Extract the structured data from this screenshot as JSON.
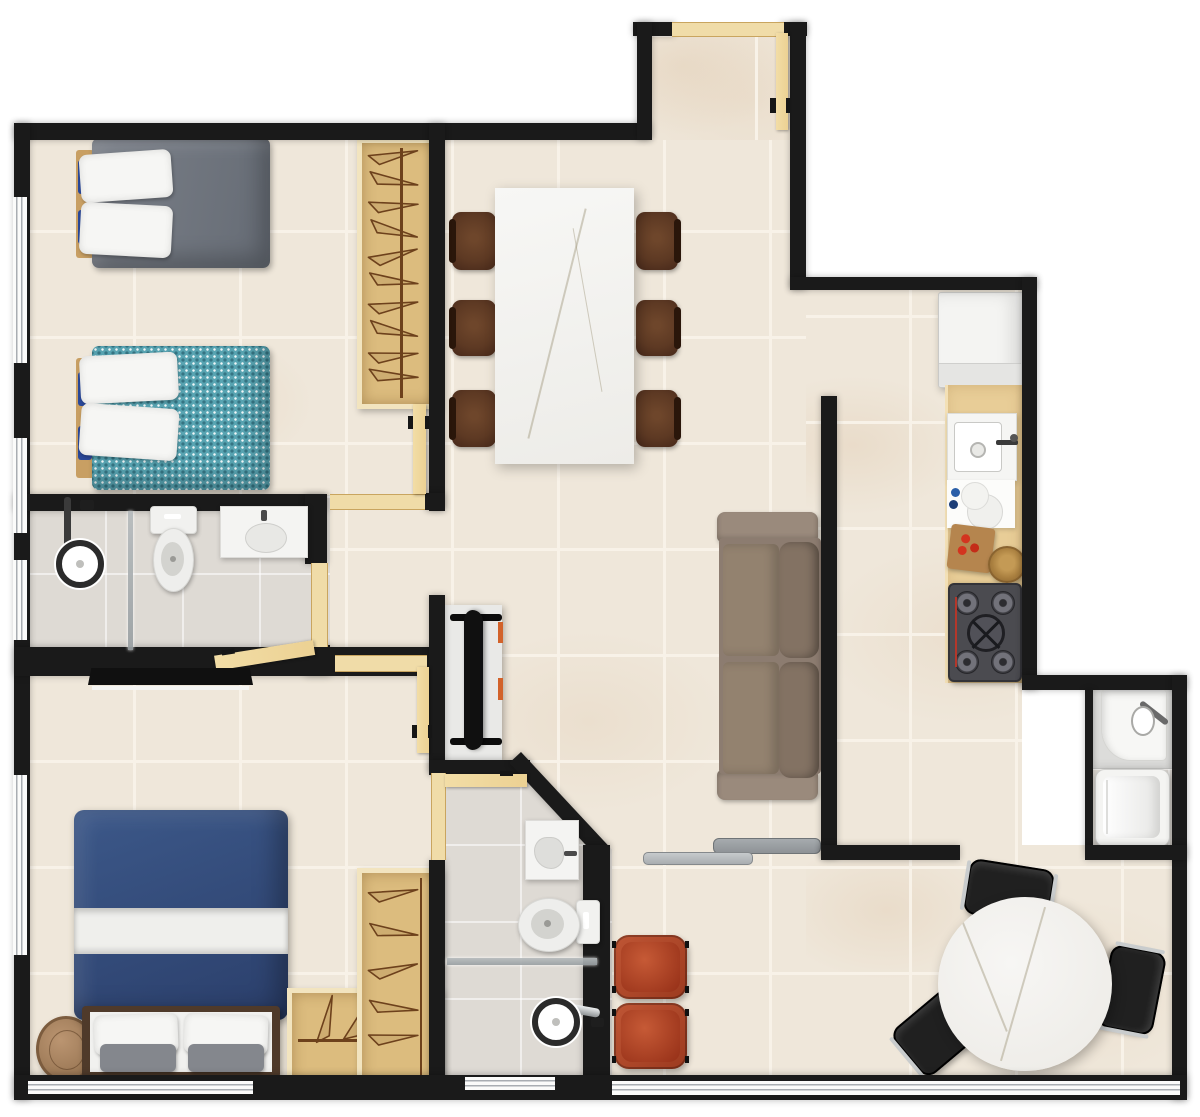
{
  "meta": {
    "title": "Two-bedroom apartment floor plan (top-down 3D render)",
    "canvas": {
      "width": 1200,
      "height": 1117
    },
    "style": "rendered architectural plan, beige tiled floors, black walls, no text labels"
  },
  "palette": {
    "wall": "#1a1a1a",
    "floor": "#efe7da",
    "floor_grout": "#f8f2e8",
    "floor_vein": "#d9bf9b",
    "bath_floor": "#dedad4",
    "door_wood": "#ecd193",
    "threshold_wood": "#f0dca8",
    "wardrobe_fill": "#dcbc7e",
    "wardrobe_edge": "#f2e4bf",
    "hanger": "#6d411c",
    "counter_wood": "#e8cd97",
    "marble": "#f5f4f1",
    "marble_vein": "#c9c2b2",
    "chair_brown": "#5d3923",
    "chair_black": "#202020",
    "sofa": "#8c7c70",
    "armchair": "#b04a2d",
    "gray_bed": "#71767f",
    "teal_bed": "#58a4b2",
    "navy_bed": "#34507e",
    "navy_accent": "#2a4899",
    "white_soft": "#f6f6f4",
    "pillow_gray": "#84878d",
    "appliance": "#f4f4f2",
    "appliance_edge": "#c9c9c7",
    "stove": "#4b4b50",
    "tv": "#101010",
    "chrome": "#c9cccd",
    "glass": "#9aa0a3",
    "wood_side_table": "#a9825c",
    "rack_gray": "#8e9296"
  },
  "rooms": [
    {
      "id": "bedroom-1",
      "label": "Bedroom 1 — two single beds (gray and teal) with hanger wardrobe"
    },
    {
      "id": "bathroom-1",
      "label": "Bathroom 1 — shower, toilet, vanity sink"
    },
    {
      "id": "bedroom-2",
      "label": "Bedroom 2 — navy double bed, side table, L-shaped wardrobe, wall TV"
    },
    {
      "id": "bathroom-2",
      "label": "Bathroom 2 — vanity, toilet, shower (angled wall)"
    },
    {
      "id": "living-dining",
      "label": "Living / dining — marble table with 6 chairs, sofa, TV console, 2 armchairs"
    },
    {
      "id": "kitchen",
      "label": "Kitchen — refrigerator, sink counter, cooktop"
    },
    {
      "id": "laundry",
      "label": "Laundry nook — tub and washing machine"
    },
    {
      "id": "dinette",
      "label": "Breakfast area — round marble table with 3 black chairs"
    },
    {
      "id": "entry",
      "label": "Entry — open front door"
    },
    {
      "id": "hall",
      "label": "Hall connecting bedrooms and bathroom"
    }
  ],
  "counts": {
    "doors": 5,
    "windows": 7,
    "dining_chairs": 6,
    "round_table_chairs": 3,
    "armchairs": 2,
    "beds": 3,
    "bathrooms": 2
  }
}
